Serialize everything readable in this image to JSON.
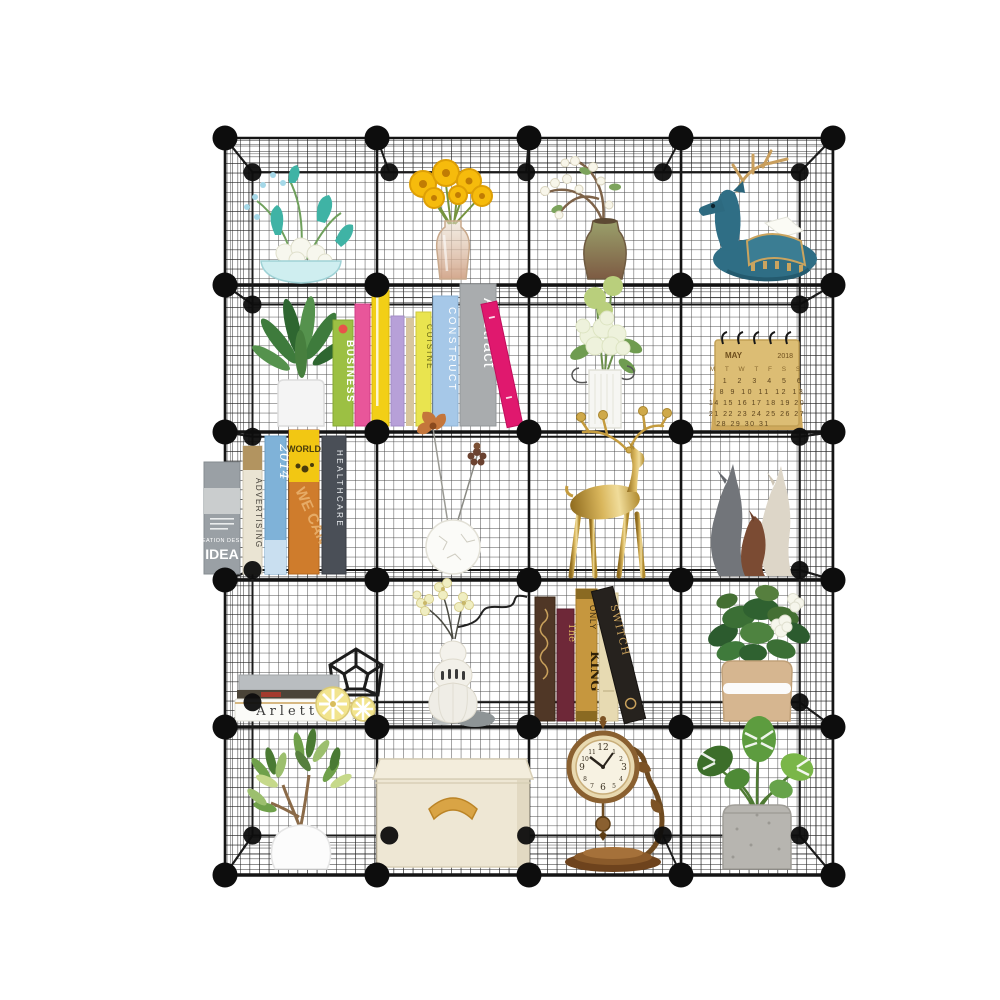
{
  "page": {
    "background": "#ffffff",
    "subject": "Product photo: black metal wire grid cube storage organizer, 4 columns by 5 rows (20 open cubes), decorated with plants, flowers, books and ornaments"
  },
  "frame": {
    "columns": 4,
    "rows": 5,
    "wire_color": "#1b1b1b",
    "connector_ball_color": "#0d0d0d",
    "mesh_color": "#262626"
  },
  "cubes": {
    "r1c1": {
      "item": "teal and white floral arrangement in pale blue bowl"
    },
    "r1c2": {
      "item": "yellow gerbera daisy bouquet in glass vase"
    },
    "r1c3": {
      "item": "arching branch with small white blossoms in rustic ceramic vase"
    },
    "r1c4": {
      "item": "reclining teal deer figurine with gold antlers holding white tissue"
    },
    "r2c1": {
      "item": "green leafy houseplant in white pot"
    },
    "r2c2": {
      "item": "row of colorful paperback books",
      "books": {
        "b1": "BUSINESS",
        "b6": "CUISINE",
        "b7": "CONSTRUCT",
        "b8": "Abstract"
      }
    },
    "r2c3": {
      "item": "white and green hydrangea bouquet in white ribbed vase"
    },
    "r2c4": {
      "item": "kraft paper spiral desk calendar",
      "calendar": {
        "month": "MAY",
        "year": "2018",
        "weekdays": "M T W T F S S",
        "week1": "1 2 3 4 5 6",
        "week2": "7 8 9 10 11 12 13",
        "week3": "14 15 16 17 18 19 20",
        "week4": "21 22 23 24 25 26 27",
        "week5": "28 29 30 31"
      }
    },
    "r3c1": {
      "item": "row of design and business books",
      "books": {
        "idea_top": "CREATION DESIGN",
        "idea": "IDEA",
        "advertising": "ADVERTISING",
        "year": "2014",
        "world": "WORLD",
        "we_can": "WE CAN",
        "healthcare": "HEALTHCARE"
      }
    },
    "r3c2": {
      "item": "round white crackle vase with copper flower and pinecone stems"
    },
    "r3c3": {
      "item": "gold standing deer candelabra with candle-cup antlers"
    },
    "r3c4": {
      "item": "three abstract ceramic deer figurines in grey, cream and brown"
    },
    "r4c1": {
      "item": "stacked books with black geometric wire ornament and two yellow striped candles",
      "books": {
        "spine": "Arlette"
      }
    },
    "r4c2": {
      "item": "tiered white ribbed vase with cream orchids, curly wire and pebbles"
    },
    "r4c3": {
      "item": "row of antique hardcover books",
      "books": {
        "v2": "The",
        "v3a": "ONLY",
        "v3b": "KING",
        "v5": "SWITCH"
      }
    },
    "r4c4": {
      "item": "gardenia plant with white blooms in tan pot with white band"
    },
    "r5c1": {
      "item": "variegated schefflera plant in round white pot"
    },
    "r5c2": {
      "item": "beige fabric storage box with lid and tan ribbon handle"
    },
    "r5c3": {
      "item": "antique bronze table clock with pendulum on scroll stand",
      "clock": {
        "n12": "12",
        "n1": "1",
        "n2": "2",
        "n3": "3",
        "n4": "4",
        "n5": "5",
        "n6": "6",
        "n7": "7",
        "n8": "8",
        "n9": "9",
        "n10": "10",
        "n11": "11"
      }
    },
    "r5c4": {
      "item": "monstera plant in speckled grey concrete pot"
    }
  }
}
